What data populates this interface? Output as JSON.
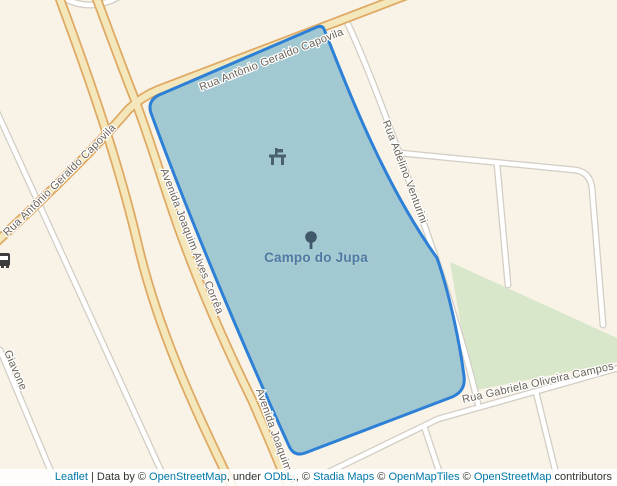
{
  "map": {
    "place": {
      "label": "Campo do Jupa"
    },
    "street_labels": {
      "capovila_west": "Rua Antônio Geraldo Capovila",
      "capovila_east": "Rua Antônio Geraldo Capovila",
      "avenida_joaquim": "Avenida Joaquim Alves Corrêa",
      "avenida_joaquim_south": "Avenida Joaquim Alves Corrêa",
      "rua_adelino": "Rua Adelino Venturini",
      "rua_gabriela": "Rua Gabriela Oliveira Campos",
      "giavone": "Giavone"
    },
    "icons": [
      "bus-stop-icon",
      "picnic-table-icon",
      "tree-icon"
    ],
    "colors": {
      "land": "#f8f2e7",
      "road_fill": "#f3e7bb",
      "road_casing": "#dfa963",
      "white_road_fill": "#ffffff",
      "white_road_casing": "#d2cdc4",
      "greenspace": "#d8e6ca",
      "polygon_fill": "#a2c9d2",
      "polygon_stroke": "#2d80d6",
      "place_label_color": "#4d7ba3",
      "street_label_color": "#6a6257",
      "link_color": "#0078a8"
    }
  },
  "attribution": {
    "leaflet": "Leaflet",
    "sep1": " | Data by © ",
    "osm1": "OpenStreetMap",
    "sep2": ", under ",
    "odbl": "ODbL.",
    "sep3": ", © ",
    "stadia": "Stadia Maps",
    "sep4": " © ",
    "openmaptiles": "OpenMapTiles",
    "sep5": " © ",
    "osm2": "OpenStreetMap",
    "sep6": " contributors"
  }
}
